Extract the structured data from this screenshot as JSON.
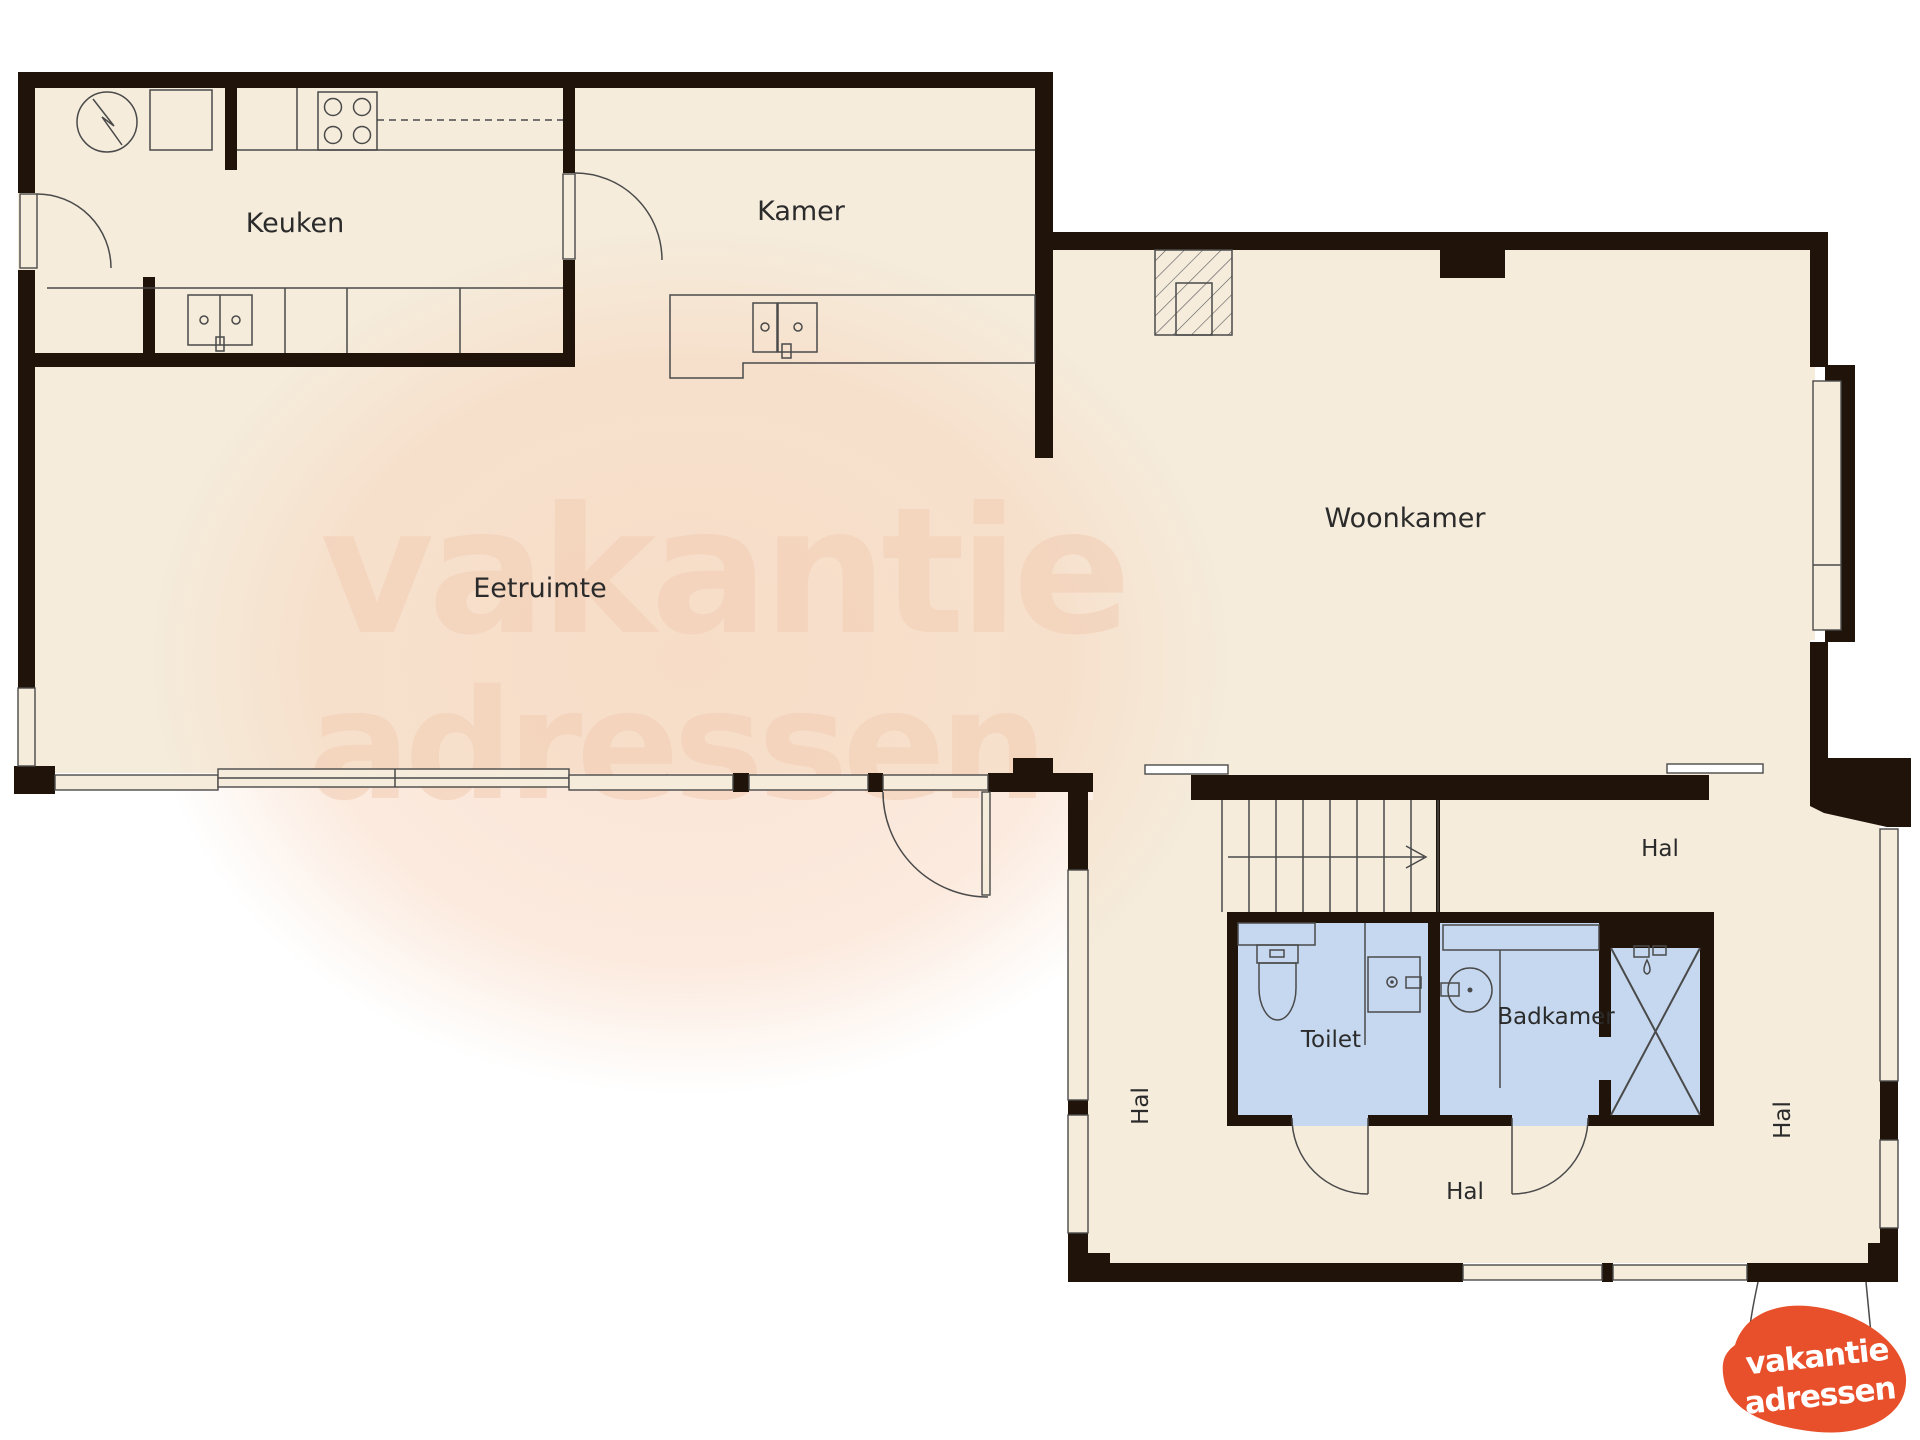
{
  "plan": {
    "rooms": {
      "keuken": "Keuken",
      "kamer": "Kamer",
      "eetruimte": "Eetruimte",
      "woonkamer": "Woonkamer",
      "toilet": "Toilet",
      "badkamer": "Badkamer",
      "hal_top": "Hal",
      "hal_bottom": "Hal",
      "hal_left": "Hal",
      "hal_right": "Hal"
    }
  },
  "watermark": {
    "line1": "vakantie",
    "line2": "adressen"
  },
  "logo": {
    "line1": "vakantie",
    "line2": "adressen"
  },
  "colors": {
    "bg": "#ffffff",
    "floor": "#f5ecdc",
    "wall": "#20130a",
    "wetroom": "#c5d8f0",
    "line": "#4a4a4a",
    "label": "#2b2b2b",
    "watermark": "#f2cdb4",
    "logo-orange": "#e8502b"
  }
}
